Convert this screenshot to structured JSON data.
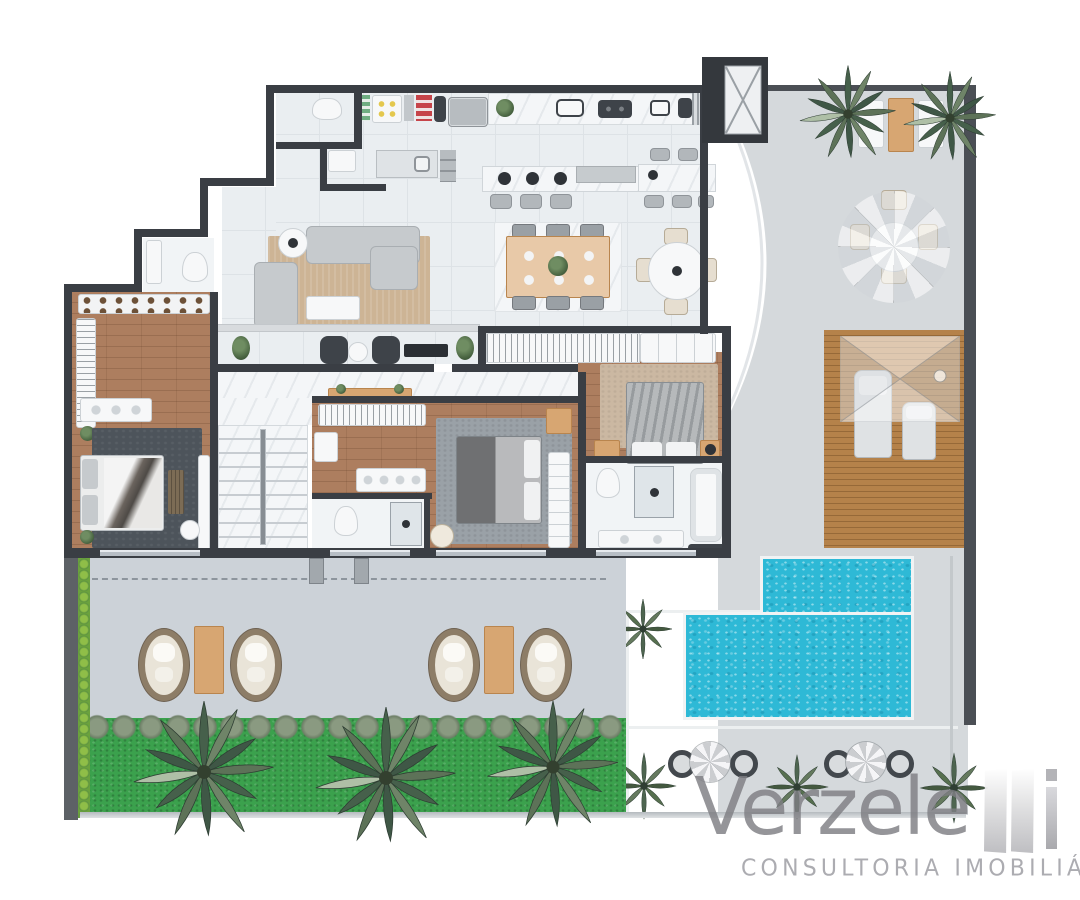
{
  "brand": {
    "name": "Verzeletti",
    "wordmark_main": "Verzele",
    "wordmark_tail": "i",
    "tagline": "CONSULTORIA IMOBILIÁRIA"
  },
  "colors": {
    "wall": "#3a3e44",
    "wall_mid": "#5d6166",
    "terrace": "#d5d9dc",
    "terrace_cool": "#ccd2d8",
    "tile": "#eaeef1",
    "tile_line": "#dde2e6",
    "marble": "#f4f6f8",
    "wood": "#ad7e5f",
    "wood_dark": "#9c6e50",
    "deckwood": "#b5824a",
    "deckwood_dark": "#9c6c35",
    "pool": "#2eb9d6",
    "grass": "#3ba14d",
    "rug_dark": "#4d545b",
    "rug_gray": "#9aa1a7",
    "rug_beige": "#cbb8a2",
    "rug_living": "#cdb495",
    "sofa": "#c6cacd",
    "dark_furn": "#3e4349",
    "wood_furn": "#d7a672",
    "white_furn": "#f7f8f9",
    "red": "#c6444a",
    "yellow": "#e4c84e",
    "logo_gray": "#97979b",
    "logo_light": "#c5c5c9"
  }
}
